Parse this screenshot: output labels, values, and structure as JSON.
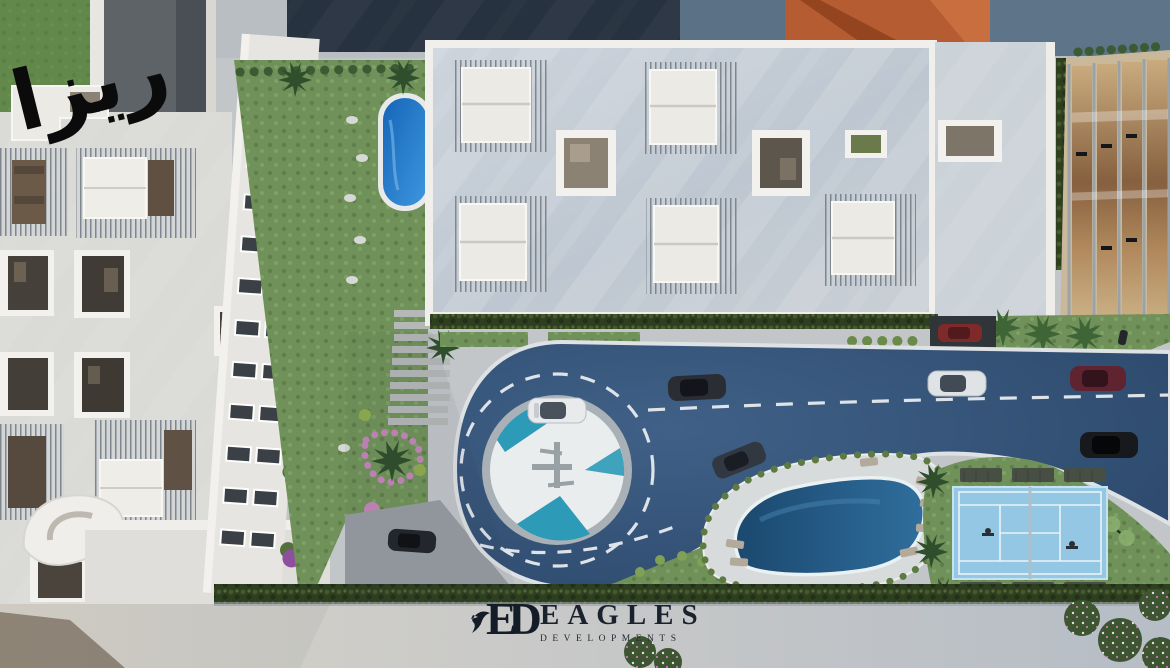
{
  "branding": {
    "arabic_logo": "ريزا",
    "monogram": "ED",
    "developer_name": "EAGLES",
    "developer_subtitle": "DEVELOPMENTS"
  },
  "palette": {
    "road_blue": "#375677",
    "lap_pool_blue": "#2a5d8a",
    "garden_pool_blue": "#2a84d2",
    "tennis_court_blue": "#93c7e4",
    "plaza_teal": "#2d9ab8",
    "grass_green": "#70925a",
    "hedge_green": "#31421f",
    "roof_gray": "#c3cbd4",
    "parapet_white": "#f0efeb",
    "terracotta_roof": "#b65c33",
    "logo_navy": "#1a222e",
    "calligraphy_black": "#0b0b0b"
  }
}
